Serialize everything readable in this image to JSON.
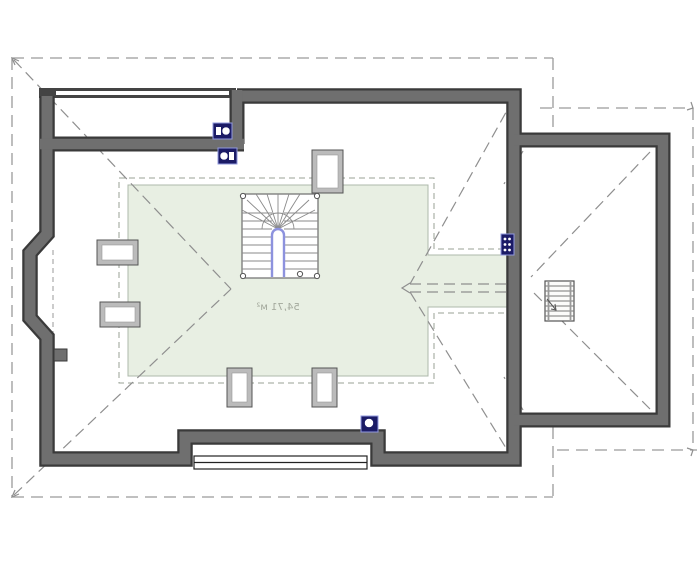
{
  "meta": {
    "area_label": "54,71 м²",
    "drawing_type": "attic-roof-floor-plan"
  },
  "colors": {
    "wall_fill": "#6f6f6f",
    "wall_outline": "#3a3a3a",
    "habitable_zone_green": "#e8efe3",
    "zone_border": "#aeb8ab",
    "dash_gray": "#9a9a9a",
    "hip_gray": "#8f8f8f",
    "vent_navy": "#1b1b66",
    "vent_border_blue": "#929ade",
    "stair_rail_blue": "#8d92de",
    "label_gray": "#a3a89c"
  },
  "plan": {
    "shapes": [
      {
        "t": "poly",
        "n": "habitable-area-zone",
        "p": "128,185 428,185 428,255 507,255 507,307 428,307 428,376 128,376",
        "f": "#e8efe3",
        "s": "#aeb8ab",
        "w": 1
      },
      {
        "t": "poly",
        "n": "height-limit-dashed-outline",
        "p": "119,178 434,178 434,249 514,249 514,313 434,313 434,383 119,383",
        "f": "none",
        "s": "#99a296",
        "w": 1,
        "da": "6,4"
      },
      {
        "t": "line",
        "n": "roof-overhang-top",
        "x1": 12,
        "y1": 58,
        "x2": 553,
        "y2": 58,
        "s": "#9a9a9a",
        "w": 1.3,
        "da": "12,7"
      },
      {
        "t": "line",
        "n": "roof-overhang-left",
        "x1": 12,
        "y1": 58,
        "x2": 12,
        "y2": 497,
        "s": "#9a9a9a",
        "w": 1.3,
        "da": "12,7"
      },
      {
        "t": "line",
        "n": "roof-overhang-bottom",
        "x1": 12,
        "y1": 497,
        "x2": 553,
        "y2": 497,
        "s": "#9a9a9a",
        "w": 1.3,
        "da": "12,7"
      },
      {
        "t": "line",
        "n": "roof-overhang-right-upper",
        "x1": 553,
        "y1": 58,
        "x2": 553,
        "y2": 133,
        "s": "#9a9a9a",
        "w": 1.3,
        "da": "12,7"
      },
      {
        "t": "line",
        "n": "roof-overhang-right-lower",
        "x1": 553,
        "y1": 427,
        "x2": 553,
        "y2": 497,
        "s": "#9a9a9a",
        "w": 1.3,
        "da": "12,7"
      },
      {
        "t": "line",
        "n": "ext-roof-overhang-top",
        "x1": 540,
        "y1": 108,
        "x2": 693,
        "y2": 108,
        "s": "#9a9a9a",
        "w": 1.3,
        "da": "12,7"
      },
      {
        "t": "line",
        "n": "ext-roof-overhang-right",
        "x1": 693,
        "y1": 108,
        "x2": 693,
        "y2": 450,
        "s": "#9a9a9a",
        "w": 1.3,
        "da": "12,7"
      },
      {
        "t": "line",
        "n": "ext-roof-overhang-bottom",
        "x1": 557,
        "y1": 450,
        "x2": 697,
        "y2": 450,
        "s": "#9a9a9a",
        "w": 1.3,
        "da": "12,7"
      },
      {
        "t": "line",
        "n": "hip-line-top-left",
        "x1": 14,
        "y1": 60,
        "x2": 231,
        "y2": 289,
        "s": "#8f8f8f",
        "w": 1.2,
        "da": "11,6"
      },
      {
        "t": "line",
        "n": "hip-line-bottom-left",
        "x1": 14,
        "y1": 495,
        "x2": 231,
        "y2": 289,
        "s": "#8f8f8f",
        "w": 1.2,
        "da": "11,6"
      },
      {
        "t": "line",
        "n": "hip-line-top-right",
        "x1": 514,
        "y1": 98,
        "x2": 410,
        "y2": 284,
        "s": "#8f8f8f",
        "w": 1.2,
        "da": "11,6"
      },
      {
        "t": "line",
        "n": "hip-line-bottom-right",
        "x1": 514,
        "y1": 461,
        "x2": 410,
        "y2": 292,
        "s": "#8f8f8f",
        "w": 1.2,
        "da": "11,6"
      },
      {
        "t": "line",
        "n": "ridge-line-upper",
        "x1": 410,
        "y1": 284,
        "x2": 512,
        "y2": 284,
        "s": "#8f8f8f",
        "w": 1.2,
        "da": "11,6"
      },
      {
        "t": "line",
        "n": "ridge-line-lower",
        "x1": 410,
        "y1": 292,
        "x2": 512,
        "y2": 292,
        "s": "#8f8f8f",
        "w": 1.2,
        "da": "11,6"
      },
      {
        "t": "line",
        "n": "ext-hip-line-top",
        "x1": 650,
        "y1": 152,
        "x2": 531,
        "y2": 277,
        "s": "#8f8f8f",
        "w": 1.2,
        "da": "11,6"
      },
      {
        "t": "line",
        "n": "ext-hip-line-bottom",
        "x1": 650,
        "y1": 409,
        "x2": 531,
        "y2": 290,
        "s": "#8f8f8f",
        "w": 1.2,
        "da": "11,6"
      },
      {
        "t": "line",
        "n": "valley-line-top-junction",
        "x1": 523,
        "y1": 151,
        "x2": 504,
        "y2": 184,
        "s": "#8f8f8f",
        "w": 1.2,
        "da": "7,5"
      },
      {
        "t": "line",
        "n": "valley-line-bottom-junction",
        "x1": 523,
        "y1": 410,
        "x2": 504,
        "y2": 377,
        "s": "#8f8f8f",
        "w": 1.2,
        "da": "7,5"
      },
      {
        "t": "polyline",
        "n": "ridge-arrow-left",
        "p": "410,283 402,288 410,293",
        "f": "none",
        "s": "#8f8f8f",
        "w": 1.2
      },
      {
        "t": "polyline",
        "n": "overhang-arrow-nw",
        "p": "19,61 12,58 15,65",
        "f": "none",
        "s": "#8f8f8f",
        "w": 1.2
      },
      {
        "t": "polyline",
        "n": "overhang-arrow-sw",
        "p": "19,494 12,497 15,490",
        "f": "none",
        "s": "#8f8f8f",
        "w": 1.2
      },
      {
        "t": "polyline",
        "n": "overhang-arrow-ne",
        "p": "687,110 693,108 691,102",
        "f": "none",
        "s": "#8f8f8f",
        "w": 1.2
      },
      {
        "t": "polyline",
        "n": "overhang-arrow-se",
        "x1": 0,
        "p": "687,448 693,450 691,456",
        "f": "none",
        "s": "#8f8f8f",
        "w": 1.2
      },
      {
        "t": "line",
        "n": "bay-wall-plane-dashed",
        "x1": 53,
        "y1": 250,
        "x2": 53,
        "y2": 336,
        "s": "#999999",
        "w": 1,
        "da": "5,4"
      },
      {
        "t": "line",
        "n": "parapet-wall-dark",
        "x1": 39,
        "y1": 93,
        "x2": 236,
        "y2": 93,
        "s": "#444444",
        "w": 10
      },
      {
        "t": "line",
        "n": "parapet-wall-core",
        "x1": 56,
        "y1": 93,
        "x2": 229,
        "y2": 93,
        "s": "#ffffff",
        "w": 4
      },
      {
        "t": "path",
        "n": "main-wall-outline-dark",
        "d": "M237,96 H514 V459 H378 V437 H185 V459 H47 V337 L30,318 V253 L47,234 V96",
        "f": "none",
        "s": "#3a3a3a",
        "w": 15.5
      },
      {
        "t": "path",
        "n": "ext-wall-outline-dark",
        "d": "M514,140 H663 V420 H514",
        "f": "none",
        "s": "#3a3a3a",
        "w": 15
      },
      {
        "t": "line",
        "n": "inner-top-wall-dark",
        "x1": 40,
        "y1": 144,
        "x2": 244,
        "y2": 144,
        "s": "#3a3a3a",
        "w": 15
      },
      {
        "t": "line",
        "n": "step-wall-dark",
        "x1": 237,
        "y1": 90,
        "x2": 237,
        "y2": 144,
        "s": "#3a3a3a",
        "w": 15
      },
      {
        "t": "path",
        "n": "main-wall-outline",
        "d": "M237,96 H514 V459 H378 V437 H185 V459 H47 V337 L30,318 V253 L47,234 V96",
        "f": "none",
        "s": "#6f6f6f",
        "w": 11
      },
      {
        "t": "path",
        "n": "ext-wall-outline",
        "d": "M514,140 H663 V420 H514",
        "f": "none",
        "s": "#6f6f6f",
        "w": 10.5
      },
      {
        "t": "line",
        "n": "inner-top-wall",
        "x1": 40,
        "y1": 144,
        "x2": 244,
        "y2": 144,
        "s": "#6f6f6f",
        "w": 10.5
      },
      {
        "t": "line",
        "n": "step-wall",
        "x1": 237,
        "y1": 90,
        "x2": 237,
        "y2": 144,
        "s": "#6f6f6f",
        "w": 10.5
      },
      {
        "t": "rect",
        "n": "wall-stub",
        "x": 54,
        "y": 349,
        "w": 13,
        "h": 12,
        "f": "#6f6f6f",
        "s": "#3a3a3a",
        "sw": 1
      },
      {
        "t": "rect",
        "n": "dormer-window-band",
        "x": 194,
        "y": 456,
        "w": 173,
        "h": 13,
        "f": "#ffffff",
        "s": "#222222",
        "sw": 1.2
      },
      {
        "t": "line",
        "n": "dormer-window-mullion",
        "x1": 194,
        "y1": 462.5,
        "x2": 367,
        "y2": 462.5,
        "s": "#222222",
        "w": 1.2
      },
      {
        "t": "rect",
        "n": "skylight-top-frame",
        "x": 312,
        "y": 150,
        "w": 31,
        "h": 43,
        "f": "#bbbbbb",
        "s": "#555555",
        "sw": 1
      },
      {
        "t": "rect",
        "n": "skylight-top-glass",
        "x": 317,
        "y": 155,
        "w": 21,
        "h": 33,
        "f": "#ffffff",
        "s": "#999999",
        "sw": 0.6
      },
      {
        "t": "rect",
        "n": "skylight-left-upper-frame",
        "x": 97,
        "y": 240,
        "w": 41,
        "h": 25,
        "f": "#bbbbbb",
        "s": "#555555",
        "sw": 1
      },
      {
        "t": "rect",
        "n": "skylight-left-upper-glass",
        "x": 102,
        "y": 245,
        "w": 31,
        "h": 15,
        "f": "#ffffff",
        "s": "#999999",
        "sw": 0.6
      },
      {
        "t": "rect",
        "n": "skylight-left-lower-frame",
        "x": 100,
        "y": 302,
        "w": 40,
        "h": 25,
        "f": "#bbbbbb",
        "s": "#555555",
        "sw": 1
      },
      {
        "t": "rect",
        "n": "skylight-left-lower-glass",
        "x": 105,
        "y": 307,
        "w": 30,
        "h": 15,
        "f": "#ffffff",
        "s": "#999999",
        "sw": 0.6
      },
      {
        "t": "rect",
        "n": "skylight-bottom-left-frame",
        "x": 227,
        "y": 368,
        "w": 25,
        "h": 39,
        "f": "#bbbbbb",
        "s": "#555555",
        "sw": 1
      },
      {
        "t": "rect",
        "n": "skylight-bottom-left-glass",
        "x": 232,
        "y": 373,
        "w": 15,
        "h": 29,
        "f": "#ffffff",
        "s": "#999999",
        "sw": 0.6
      },
      {
        "t": "rect",
        "n": "skylight-bottom-right-frame",
        "x": 312,
        "y": 368,
        "w": 25,
        "h": 39,
        "f": "#bbbbbb",
        "s": "#555555",
        "sw": 1
      },
      {
        "t": "rect",
        "n": "skylight-bottom-right-glass",
        "x": 317,
        "y": 373,
        "w": 15,
        "h": 29,
        "f": "#ffffff",
        "s": "#999999",
        "sw": 0.6
      },
      {
        "t": "rect",
        "n": "vent-chimney-top-outer",
        "x": 213,
        "y": 123,
        "w": 19,
        "h": 16,
        "f": "#1b1b66",
        "s": "#929ade",
        "sw": 1
      },
      {
        "t": "rect",
        "n": "vent-chimney-top-outer-slot",
        "x": 216,
        "y": 127,
        "w": 5,
        "h": 8,
        "f": "#ffffff"
      },
      {
        "t": "circle",
        "n": "vent-chimney-top-outer-flue",
        "cx": 226,
        "cy": 131,
        "r": 4,
        "f": "#ffffff",
        "s": "#1b1b66",
        "sw": 0.5
      },
      {
        "t": "rect",
        "n": "vent-chimney-top-inner",
        "x": 218,
        "y": 148,
        "w": 19,
        "h": 16,
        "f": "#1b1b66",
        "s": "#929ade",
        "sw": 1
      },
      {
        "t": "circle",
        "n": "vent-chimney-top-inner-flue",
        "cx": 224,
        "cy": 156,
        "r": 4,
        "f": "#ffffff",
        "s": "#1b1b66",
        "sw": 0.5
      },
      {
        "t": "rect",
        "n": "vent-chimney-top-inner-slot",
        "x": 229,
        "y": 152,
        "w": 5,
        "h": 8,
        "f": "#ffffff"
      },
      {
        "t": "rect",
        "n": "vent-chimney-bottom",
        "x": 361,
        "y": 416,
        "w": 17,
        "h": 16,
        "f": "#1b1b66",
        "s": "#929ade",
        "sw": 1
      },
      {
        "t": "circle",
        "n": "vent-chimney-bottom-flue",
        "cx": 369,
        "cy": 423,
        "r": 4.5,
        "f": "#ffffff",
        "s": "#1b1b66",
        "sw": 0.5
      },
      {
        "t": "rect",
        "n": "wall-vent-grille",
        "x": 501,
        "y": 234,
        "w": 13,
        "h": 21,
        "f": "#1b1b66",
        "s": "#929ade",
        "sw": 1
      },
      {
        "t": "circles",
        "n": "wall-vent-grille-holes",
        "r": 1.4,
        "f": "#ffffff",
        "pts": [
          [
            505,
            239
          ],
          [
            509.5,
            239
          ],
          [
            505,
            244.5
          ],
          [
            509.5,
            244.5
          ],
          [
            505,
            250
          ],
          [
            509.5,
            250
          ]
        ]
      },
      {
        "t": "rect",
        "n": "stair-outline",
        "x": 242,
        "y": 194,
        "w": 76,
        "h": 84,
        "f": "#ffffff",
        "s": "#777777",
        "sw": 1.3
      },
      {
        "t": "lines",
        "n": "stair-treads-left",
        "s": "#8a8a8a",
        "w": 0.9,
        "segs": [
          [
            242,
            213,
            272,
            213
          ],
          [
            242,
            221,
            272,
            221
          ],
          [
            242,
            229,
            272,
            229
          ],
          [
            242,
            237,
            272,
            237
          ],
          [
            242,
            245,
            272,
            245
          ],
          [
            242,
            253,
            272,
            253
          ],
          [
            242,
            261,
            272,
            261
          ],
          [
            242,
            269,
            272,
            269
          ]
        ]
      },
      {
        "t": "lines",
        "n": "stair-treads-right",
        "s": "#8a8a8a",
        "w": 0.9,
        "segs": [
          [
            284,
            213,
            318,
            213
          ],
          [
            284,
            221,
            318,
            221
          ],
          [
            284,
            229,
            318,
            229
          ],
          [
            284,
            237,
            318,
            237
          ],
          [
            284,
            245,
            318,
            245
          ],
          [
            284,
            253,
            318,
            253
          ],
          [
            284,
            261,
            318,
            261
          ],
          [
            284,
            269,
            318,
            269
          ]
        ]
      },
      {
        "t": "lines",
        "n": "stair-winder-fan",
        "s": "#8a8a8a",
        "w": 0.9,
        "segs": [
          [
            278,
            229,
            242,
            210
          ],
          [
            278,
            229,
            247,
            200
          ],
          [
            278,
            229,
            256,
            194
          ],
          [
            278,
            229,
            267,
            194
          ],
          [
            278,
            229,
            278,
            194
          ],
          [
            278,
            229,
            289,
            194
          ],
          [
            278,
            229,
            300,
            194
          ],
          [
            278,
            229,
            309,
            200
          ],
          [
            278,
            229,
            315,
            210
          ]
        ]
      },
      {
        "t": "path",
        "n": "stair-winder-arc",
        "d": "M262,229 A16,16 0 0 1 294,229",
        "f": "none",
        "s": "#8a8a8a",
        "w": 0.9
      },
      {
        "t": "path",
        "n": "stair-handrail",
        "d": "M272,277 V235 A6,6 0 0 1 284,235 V277",
        "f": "none",
        "s": "#8d92de",
        "w": 2.4
      },
      {
        "t": "circles",
        "n": "stair-newel-posts",
        "r": 2.6,
        "f": "#ffffff",
        "s": "#555555",
        "sw": 1,
        "pts": [
          [
            243,
            196
          ],
          [
            317,
            196
          ],
          [
            243,
            276
          ],
          [
            317,
            276
          ],
          [
            300,
            274
          ]
        ]
      },
      {
        "t": "rect",
        "n": "ext-ladder-outline",
        "x": 545,
        "y": 281,
        "w": 29,
        "h": 40,
        "f": "#fbfbfa",
        "s": "#555555",
        "sw": 1.2
      },
      {
        "t": "lines",
        "n": "ext-ladder-rungs",
        "s": "#777777",
        "w": 1,
        "segs": [
          [
            545,
            286,
            574,
            286
          ],
          [
            545,
            291,
            574,
            291
          ],
          [
            545,
            296,
            574,
            296
          ],
          [
            545,
            301,
            574,
            301
          ],
          [
            545,
            306,
            574,
            306
          ],
          [
            545,
            311,
            574,
            311
          ],
          [
            545,
            316,
            574,
            316
          ]
        ]
      },
      {
        "t": "lines",
        "n": "ext-ladder-rails",
        "s": "#999999",
        "w": 1.8,
        "segs": [
          [
            548.5,
            281,
            548.5,
            321
          ],
          [
            570.5,
            281,
            570.5,
            321
          ]
        ]
      },
      {
        "t": "line",
        "n": "ext-ladder-direction-arrow",
        "x1": 547,
        "y1": 299,
        "x2": 556,
        "y2": 310,
        "s": "#555555",
        "w": 1
      },
      {
        "t": "polyline",
        "n": "ext-ladder-arrowhead",
        "p": "551,309 556,310 555,304",
        "f": "none",
        "s": "#555555",
        "w": 1
      },
      {
        "t": "text",
        "n": "area-label",
        "x": 278,
        "y": 310,
        "size": 10,
        "f": "#a3a89c",
        "mirror": true,
        "bind": "meta.area_label"
      }
    ]
  }
}
